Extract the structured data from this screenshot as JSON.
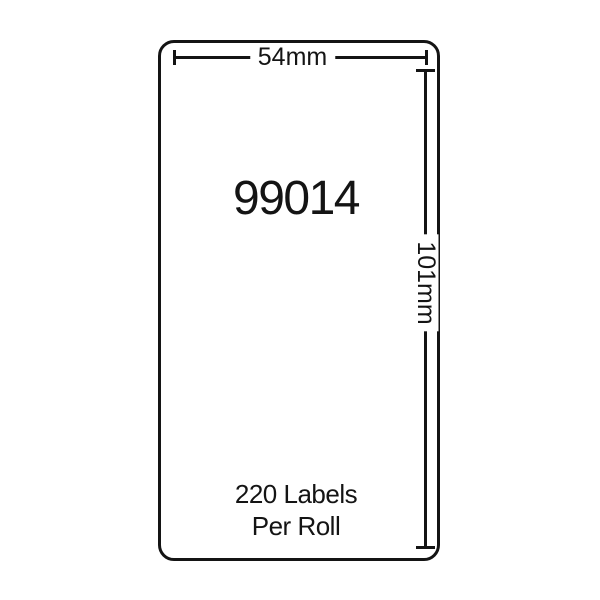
{
  "diagram": {
    "product_code": "99014",
    "width_dimension_label": "54mm",
    "height_dimension_label": "101mm",
    "roll_info_line1": "220 Labels",
    "roll_info_line2": "Per Roll"
  },
  "colors": {
    "ink": "#141414",
    "background": "#ffffff"
  }
}
